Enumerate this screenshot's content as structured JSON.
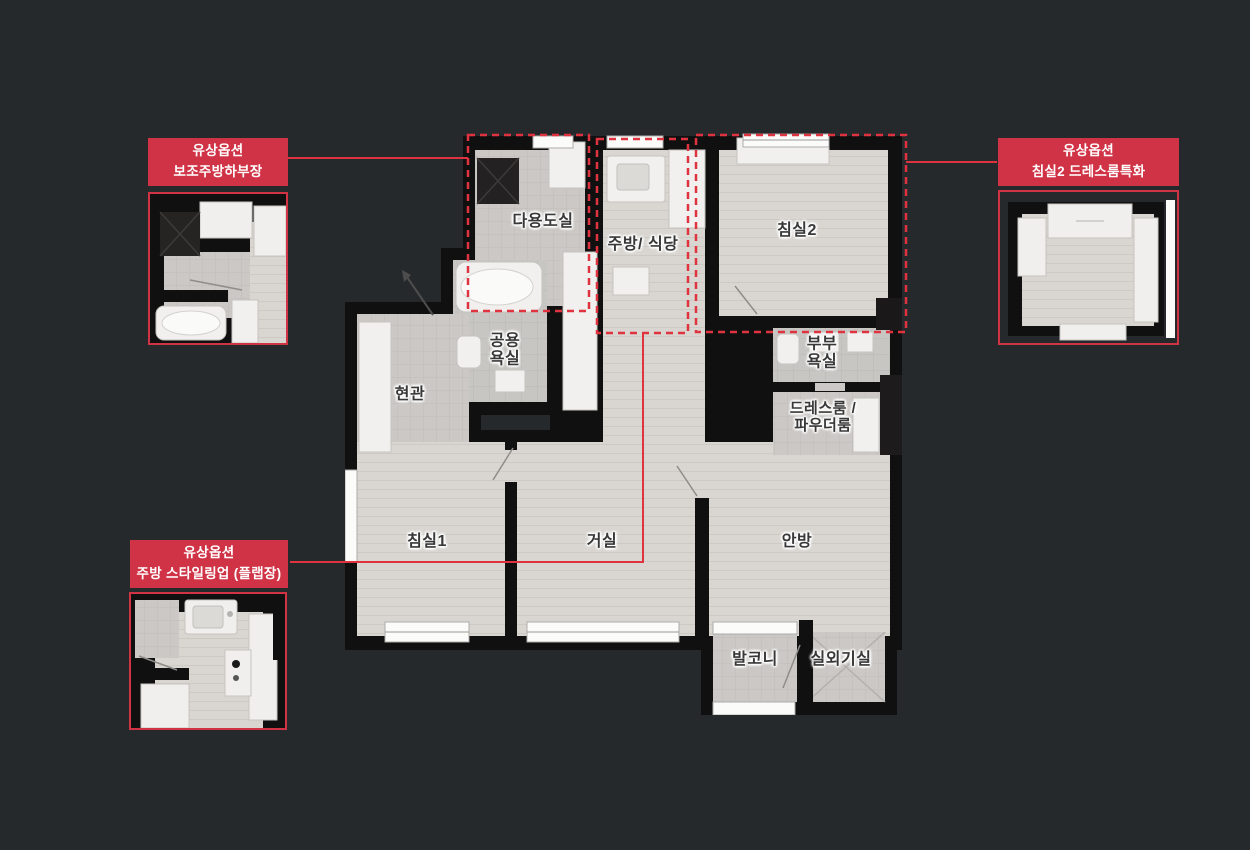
{
  "colors": {
    "background": "#26292b",
    "callout_red": "#d03345",
    "dash_red": "#e03340",
    "wall_black": "#101010",
    "wood_floor": "#d9d6d1",
    "tile_floor": "#cbc8c5",
    "label_text": "#383838"
  },
  "callouts": {
    "aux_kitchen_cabinet": {
      "title_line1": "유상옵션",
      "title_line2": "보조주방하부장"
    },
    "bedroom2_dressroom": {
      "title_line1": "유상옵션",
      "title_line2": "침실2 드레스룸특화"
    },
    "kitchen_styling": {
      "title_line1": "유상옵션",
      "title_line2": "주방 스타일링업 (플랩장)"
    }
  },
  "rooms": {
    "utility": "다용도실",
    "kitchen_dining": "주방/ 식당",
    "bedroom2": "침실2",
    "common_bath": "공용\n욕실",
    "entrance": "현관",
    "master_bath": "부부\n욕실",
    "dressroom": "드레스룸 /\n파우더룸",
    "bedroom1": "침실1",
    "living": "거실",
    "master_bedroom": "안방",
    "balcony": "발코니",
    "outdoor_unit": "실외기실"
  }
}
